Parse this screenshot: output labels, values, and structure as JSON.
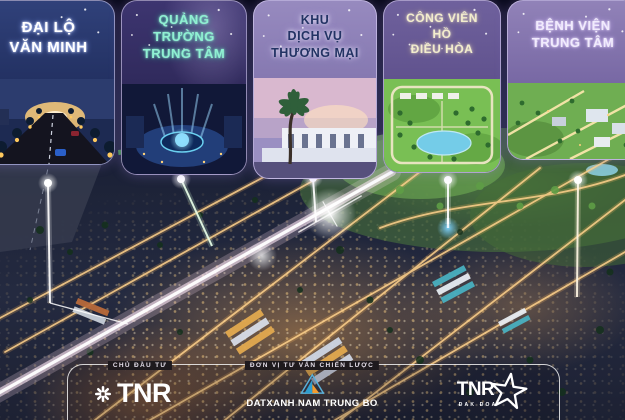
{
  "poster": {
    "cards": [
      {
        "id": "dai-lo-van-minh",
        "lines": [
          "ĐẠI LỘ",
          "VĂN MINH"
        ],
        "text_color": "#ffffff",
        "image": "night-boulevard-sunset"
      },
      {
        "id": "quang-truong-trung-tam",
        "lines": [
          "QUẢNG",
          "TRƯỜNG",
          "TRUNG TÂM"
        ],
        "text_color": "#8ff0d2",
        "image": "central-plaza-fountain"
      },
      {
        "id": "khu-dich-vu-thuong-mai",
        "lines": [
          "KHU",
          "DỊCH VỤ",
          "THƯƠNG MẠI"
        ],
        "text_color": "#233364",
        "image": "commercial-shophouses-palm"
      },
      {
        "id": "cong-vien-ho-dieu-hoa",
        "lines": [
          "CÔNG VIÊN",
          "HỒ",
          "ĐIỀU HÒA"
        ],
        "text_color": "#f3edcd",
        "image": "lake-park-aerial"
      },
      {
        "id": "benh-vien-trung-tam",
        "lines": [
          "BỆNH VIỆN",
          "TRUNG TÂM"
        ],
        "text_color": "#f1ebfd",
        "image": "hospital-area-aerial"
      }
    ],
    "footer": {
      "developer_label": "CHỦ ĐẦU TƯ",
      "consultant_label": "ĐƠN VỊ TƯ VẤN CHIẾN LƯỢC",
      "logos": {
        "tnr": {
          "text": "TNR",
          "icon": "asterisk-snowflake-icon"
        },
        "datxanh": {
          "text": "DATXANH NAM TRUNG BO",
          "icon": "triangle-logo-icon"
        },
        "tnr_stars": {
          "text": "TNR",
          "subtext": "ĐAK ĐOA",
          "icon": "star-icon"
        }
      }
    },
    "colors": {
      "road_gold": "#ffd28c",
      "boulevard_white": "#ffeaf6",
      "beam_white": "#ffffff",
      "fountain_blue": "#7fd4ff",
      "card_border": "#e4dafc"
    }
  }
}
